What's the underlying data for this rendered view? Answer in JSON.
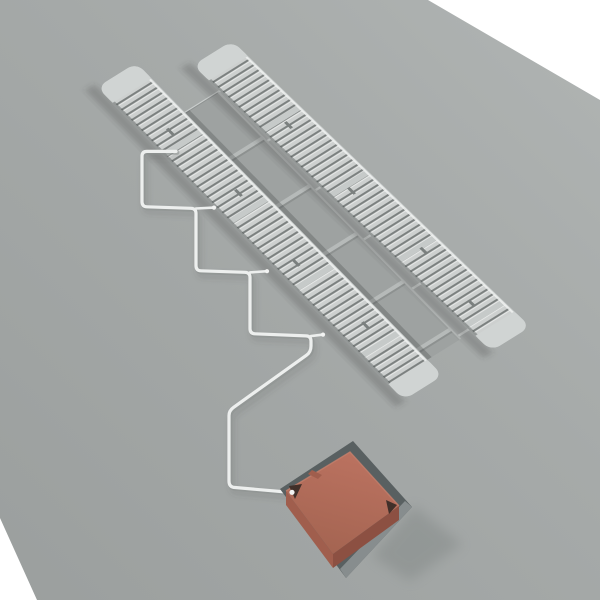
{
  "scene": {
    "kind": "3d-render-illustration",
    "objects": {
      "ground": "ground-plane",
      "strip_left": "collector-strip-left",
      "strip_right": "collector-strip-right",
      "panels": "cover-panel-band",
      "pipe": "supply-pipe",
      "box": "recessed-terracotta-box",
      "pit": "ground-pit"
    }
  },
  "colors": {
    "backdrop": "#ffffff",
    "ground_light": "#b0b4b3",
    "ground_mid": "#a6aaa9",
    "ground_dark": "#9b9f9e",
    "strip_base": "#c6cac9",
    "strip_cap": "#d0d4d3",
    "slat_face": "#cdd0cf",
    "slat_highlight": "#e7e9e8",
    "slat_gap": "#7b807f",
    "panel": "#9ea2a1",
    "panel_edge": "#b6bab9",
    "panel_shade": "#8d9190",
    "stub": "#c9cdcc",
    "pipe": "#edefee",
    "pipe_shade": "#8e9291",
    "fitting": "#f2f3f2",
    "pit": "#596061",
    "pit_wall": "#878d8e",
    "box_top_light": "#bb7260",
    "box_top_dark": "#a26350",
    "box_side_left": "#a05e4d",
    "box_side_right": "#8c5042",
    "box_notch": "#41302a",
    "box_rim": "#c67f6b"
  }
}
